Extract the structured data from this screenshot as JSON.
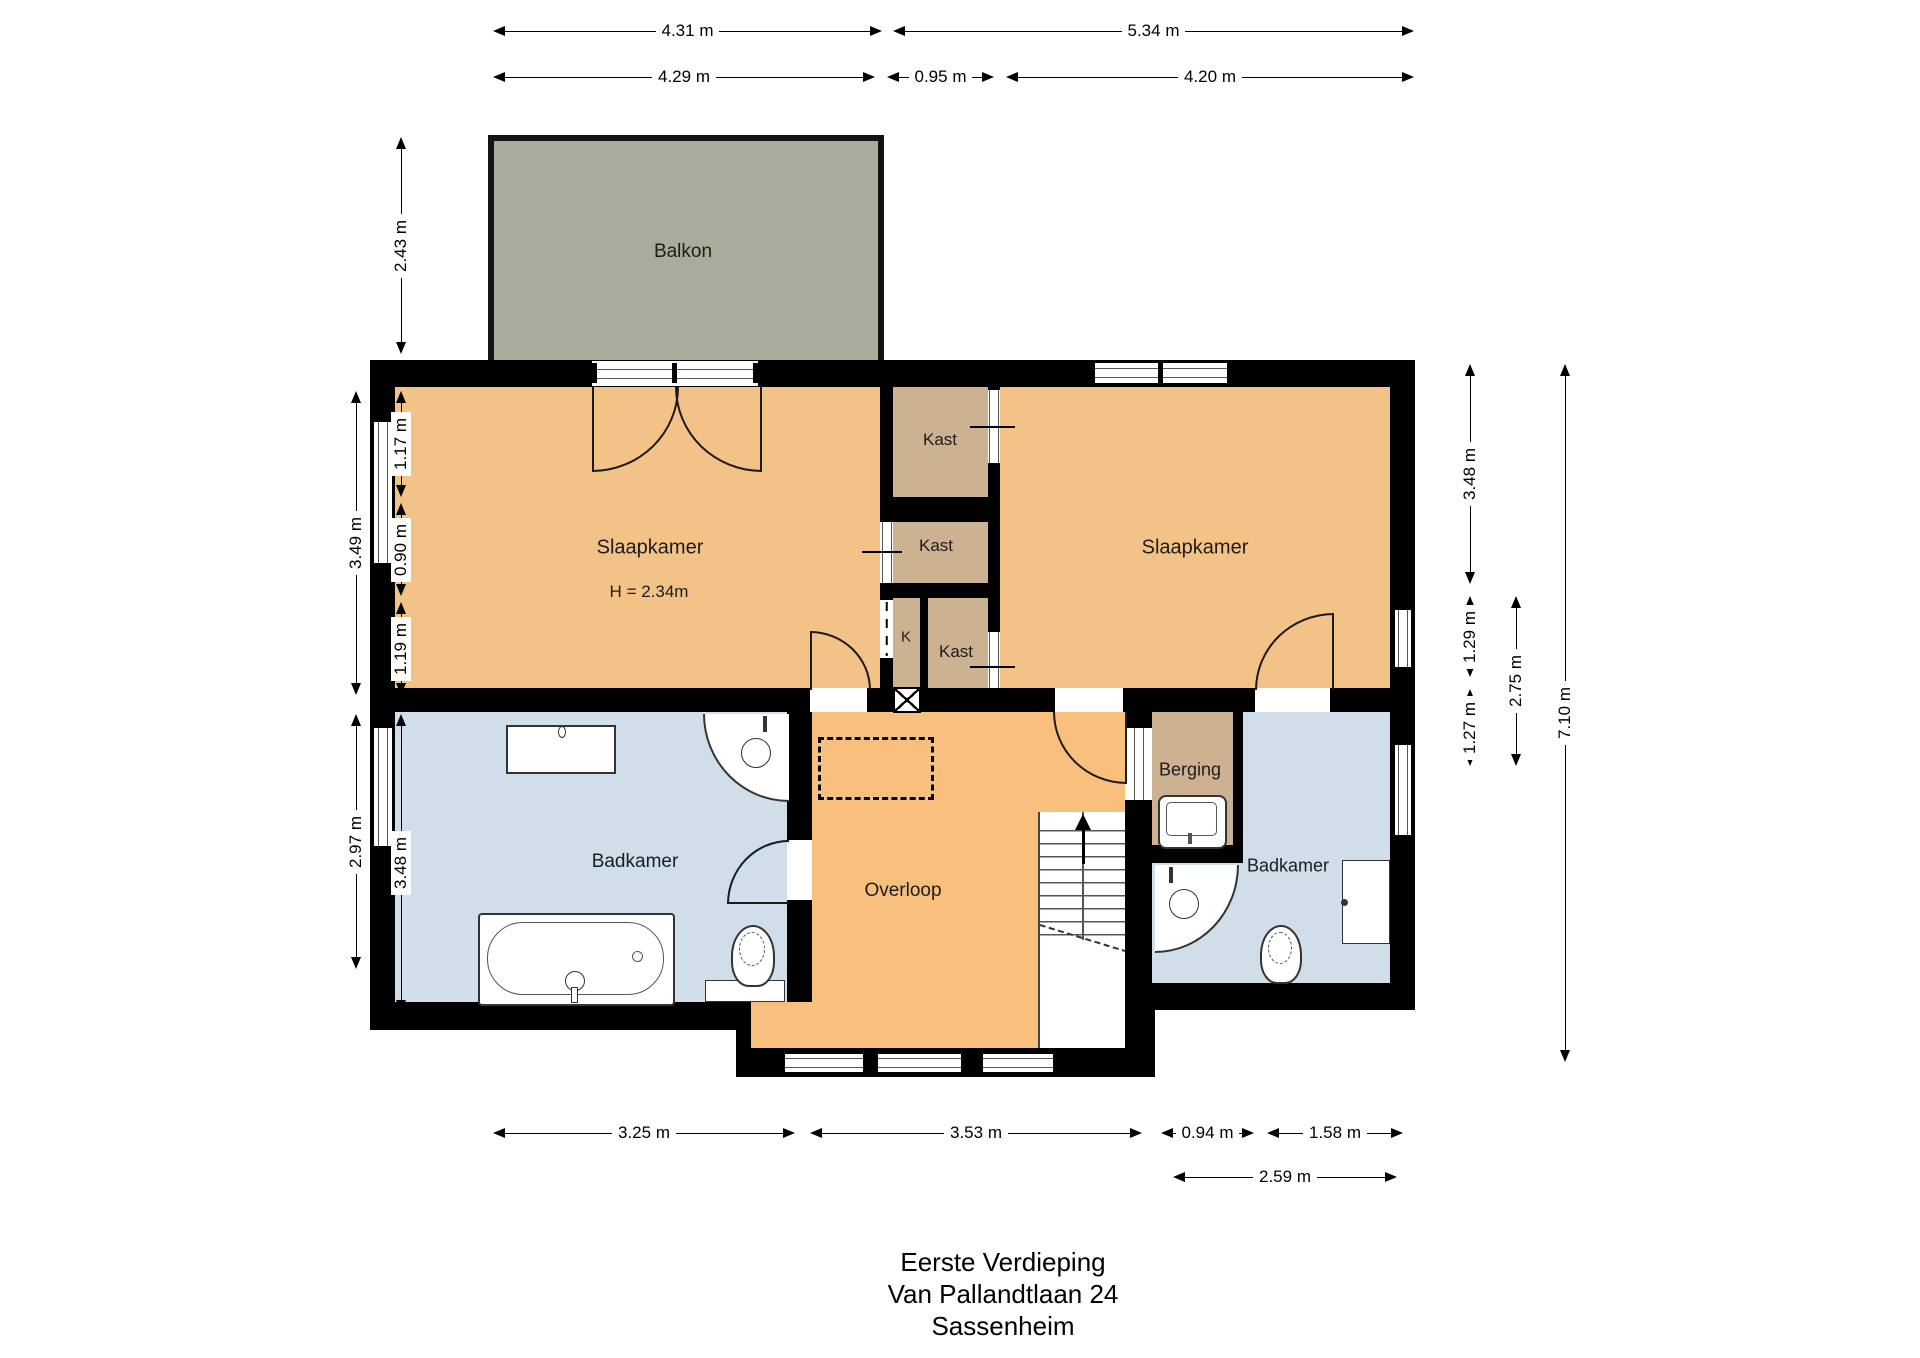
{
  "title": {
    "lines": [
      "Eerste Verdieping",
      "Van Pallandtlaan 24",
      "Sassenheim"
    ]
  },
  "colors": {
    "wall": "#000000",
    "bedroom_fill": "#F2C287",
    "hall_fill": "#F8C07C",
    "closet_fill": "#CDB292",
    "bathroom_fill": "#D0DEEA",
    "balcony_fill": "#A9AC9B",
    "line": "#1a1a1a"
  },
  "room_labels": [
    {
      "id": "balkon",
      "label": "Balkon",
      "x": 683,
      "y": 252,
      "size": 19
    },
    {
      "id": "slaapkamer-left",
      "label": "Slaapkamer",
      "x": 650,
      "y": 548,
      "size": 20
    },
    {
      "id": "slaapkamer-left-height",
      "label": "H = 2.34m",
      "x": 649,
      "y": 592,
      "size": 17
    },
    {
      "id": "kast-top",
      "label": "Kast",
      "x": 940,
      "y": 440,
      "size": 17
    },
    {
      "id": "kast-middle",
      "label": "Kast",
      "x": 936,
      "y": 546,
      "size": 17
    },
    {
      "id": "k-closet",
      "label": "K",
      "x": 906,
      "y": 637,
      "size": 15
    },
    {
      "id": "kast-bottom",
      "label": "Kast",
      "x": 956,
      "y": 652,
      "size": 17
    },
    {
      "id": "slaapkamer-right",
      "label": "Slaapkamer",
      "x": 1195,
      "y": 548,
      "size": 20
    },
    {
      "id": "badkamer-left",
      "label": "Badkamer",
      "x": 635,
      "y": 862,
      "size": 19
    },
    {
      "id": "overloop",
      "label": "Overloop",
      "x": 903,
      "y": 891,
      "size": 19
    },
    {
      "id": "berging",
      "label": "Berging",
      "x": 1190,
      "y": 770,
      "size": 18
    },
    {
      "id": "badkamer-right",
      "label": "Badkamer",
      "x": 1288,
      "y": 866,
      "size": 18
    }
  ],
  "dimensions": [
    {
      "label": "4.31 m",
      "orient": "h",
      "x": 493,
      "y": 31,
      "len": 389
    },
    {
      "label": "5.34 m",
      "orient": "h",
      "x": 893,
      "y": 31,
      "len": 521
    },
    {
      "label": "4.29 m",
      "orient": "h",
      "x": 493,
      "y": 77,
      "len": 382
    },
    {
      "label": "0.95 m",
      "orient": "h",
      "x": 887,
      "y": 77,
      "len": 107
    },
    {
      "label": "4.20 m",
      "orient": "h",
      "x": 1006,
      "y": 77,
      "len": 408
    },
    {
      "label": "2.43 m",
      "orient": "v",
      "x": 401,
      "y": 137,
      "len": 217
    },
    {
      "label": "3.49 m",
      "orient": "v",
      "x": 356,
      "y": 391,
      "len": 304
    },
    {
      "label": "1.17 m",
      "orient": "v",
      "x": 401,
      "y": 391,
      "len": 106
    },
    {
      "label": "0.90 m",
      "orient": "v",
      "x": 401,
      "y": 503,
      "len": 93
    },
    {
      "label": "1.19 m",
      "orient": "v",
      "x": 401,
      "y": 602,
      "len": 93
    },
    {
      "label": "2.97 m",
      "orient": "v",
      "x": 356,
      "y": 714,
      "len": 255
    },
    {
      "label": "3.48 m",
      "orient": "v",
      "x": 401,
      "y": 714,
      "len": 298
    },
    {
      "label": "3.48 m",
      "orient": "v",
      "x": 1470,
      "y": 364,
      "len": 220
    },
    {
      "label": "1.29 m",
      "orient": "v",
      "x": 1470,
      "y": 596,
      "len": 81
    },
    {
      "label": "1.27 m",
      "orient": "v",
      "x": 1470,
      "y": 689,
      "len": 77
    },
    {
      "label": "2.75 m",
      "orient": "v",
      "x": 1516,
      "y": 596,
      "len": 170
    },
    {
      "label": "7.10 m",
      "orient": "v",
      "x": 1565,
      "y": 364,
      "len": 698
    },
    {
      "label": "3.25 m",
      "orient": "h",
      "x": 493,
      "y": 1133,
      "len": 302
    },
    {
      "label": "3.53 m",
      "orient": "h",
      "x": 810,
      "y": 1133,
      "len": 332
    },
    {
      "label": "0.94 m",
      "orient": "h",
      "x": 1161,
      "y": 1133,
      "len": 93
    },
    {
      "label": "1.58 m",
      "orient": "h",
      "x": 1267,
      "y": 1133,
      "len": 136
    },
    {
      "label": "2.59 m",
      "orient": "h",
      "x": 1173,
      "y": 1177,
      "len": 224
    }
  ]
}
